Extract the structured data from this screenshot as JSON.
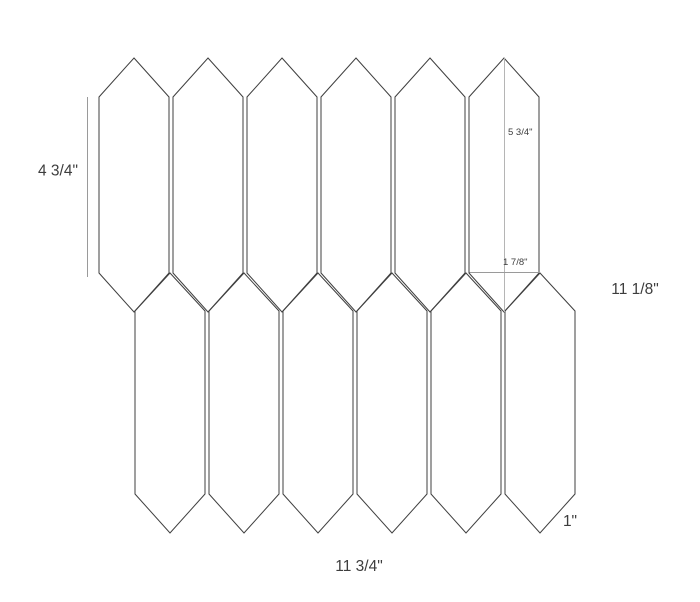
{
  "diagram": {
    "name": "picket-tile-mosaic-dimension-diagram",
    "colors": {
      "background": "#ffffff",
      "tile_outline": "#3f3f3f",
      "dimension_line": "#9a9a9a",
      "dimension_line_light": "#b5b5b5",
      "text": "#3d3d3d"
    },
    "labels": {
      "tile_side_length": "4 3/4\"",
      "tile_point_to_point": "5 3/4\"",
      "tile_half_width": "1 7/8\"",
      "sheet_height": "11 1/8\"",
      "point_height": "1\"",
      "sheet_width": "11 3/4\""
    },
    "geometry": {
      "tile_half_width_px": 35,
      "pitch_px": 74,
      "top_row": {
        "centers": [
          134,
          208,
          282,
          356,
          430,
          504
        ],
        "peak_y": 58,
        "shoulder_y": 97,
        "lower_shoulder_y": 273,
        "tip_y": 312
      },
      "bottom_row": {
        "centers": [
          170,
          244,
          318,
          392,
          466,
          540
        ],
        "peak_y": 273,
        "shoulder_y": 311,
        "lower_shoulder_y": 494,
        "tip_y": 533
      }
    }
  }
}
